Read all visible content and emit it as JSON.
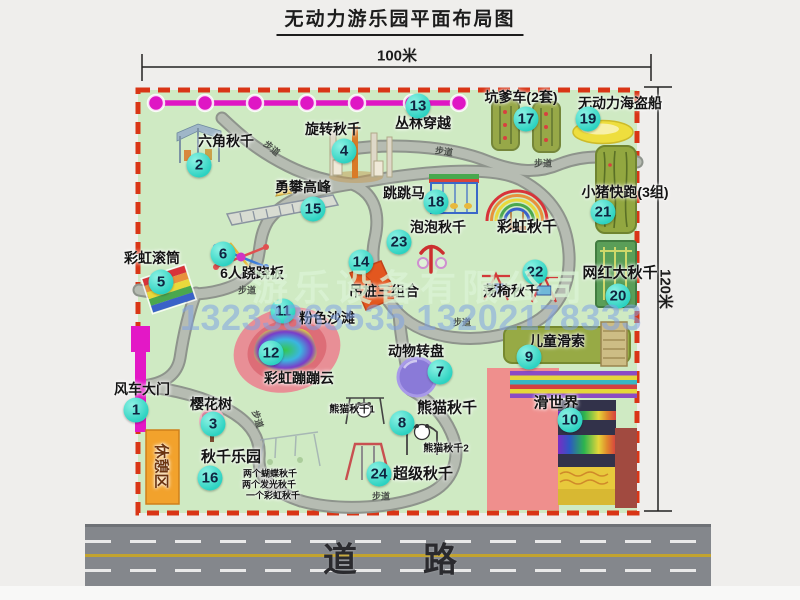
{
  "page": {
    "title": "无动力游乐园平面布局图"
  },
  "dimensions": {
    "top": "100米",
    "right": "120米"
  },
  "road": {
    "label": "道　路"
  },
  "watermark": {
    "company": "游乐设备有限公司",
    "phone": "13233863535 13202178333"
  },
  "colors": {
    "map_green": "#cfeac3",
    "border_red": "#d93516",
    "path_gray": "#b6bcb2",
    "badge_cyan": "#2cd2c1",
    "zipline_magenta": "#df16c4",
    "gate_magenta": "#e318c6",
    "rest_area_orange": "#f2a22c",
    "road_gray": "#84878c"
  },
  "map": {
    "pois": [
      {
        "num": 1,
        "label": "风车大门",
        "bx": 136,
        "by": 410,
        "lx": 142,
        "ly": 389,
        "fs": 14
      },
      {
        "num": 2,
        "label": "六角秋千",
        "bx": 199,
        "by": 165,
        "lx": 226,
        "ly": 141,
        "fs": 14
      },
      {
        "num": 3,
        "label": "樱花树",
        "bx": 213,
        "by": 424,
        "lx": 211,
        "ly": 404,
        "fs": 14
      },
      {
        "num": 4,
        "label": "旋转秋千",
        "bx": 344,
        "by": 151,
        "lx": 333,
        "ly": 129,
        "fs": 14
      },
      {
        "num": 5,
        "label": "彩虹滚筒",
        "bx": 161,
        "by": 282,
        "lx": 152,
        "ly": 258,
        "fs": 14
      },
      {
        "num": 6,
        "label": "6人跷跷板",
        "bx": 223,
        "by": 254,
        "lx": 252,
        "ly": 273,
        "fs": 14
      },
      {
        "num": 7,
        "label": "动物转盘",
        "bx": 440,
        "by": 372,
        "lx": 416,
        "ly": 351,
        "fs": 14
      },
      {
        "num": 8,
        "label": "熊猫秋千",
        "bx": 402,
        "by": 423,
        "lx": 447,
        "ly": 407,
        "fs": 15
      },
      {
        "num": 9,
        "label": "儿童滑索",
        "bx": 529,
        "by": 357,
        "lx": 557,
        "ly": 341,
        "fs": 14
      },
      {
        "num": 10,
        "label": "滑世界",
        "bx": 570,
        "by": 420,
        "lx": 556,
        "ly": 402,
        "fs": 15
      },
      {
        "num": 11,
        "label": "粉色沙滩",
        "bx": 283,
        "by": 311,
        "lx": 327,
        "ly": 318,
        "fs": 14
      },
      {
        "num": 12,
        "label": "彩虹蹦蹦云",
        "bx": 271,
        "by": 353,
        "lx": 299,
        "ly": 378,
        "fs": 14
      },
      {
        "num": 13,
        "label": "丛林穿越",
        "bx": 418,
        "by": 106,
        "lx": 423,
        "ly": 123,
        "fs": 14
      },
      {
        "num": 14,
        "label": "吊桩三组合",
        "bx": 361,
        "by": 262,
        "lx": 384,
        "ly": 291,
        "fs": 14
      },
      {
        "num": 15,
        "label": "勇攀高峰",
        "bx": 313,
        "by": 209,
        "lx": 303,
        "ly": 187,
        "fs": 14
      },
      {
        "num": 16,
        "label": "秋千乐园",
        "bx": 210,
        "by": 478,
        "lx": 231,
        "ly": 456,
        "fs": 15
      },
      {
        "num": 17,
        "label": "坑爹车(2套)",
        "bx": 526,
        "by": 119,
        "lx": 521,
        "ly": 97,
        "fs": 14
      },
      {
        "num": 18,
        "label": "跳跳马",
        "bx": 436,
        "by": 202,
        "lx": 404,
        "ly": 193,
        "fs": 14
      },
      {
        "num": 19,
        "label": "无动力海盗船",
        "bx": 588,
        "by": 119,
        "lx": 620,
        "ly": 103,
        "fs": 14
      },
      {
        "num": 20,
        "label": "网红大秋千",
        "bx": 618,
        "by": 296,
        "lx": 620,
        "ly": 272,
        "fs": 15
      },
      {
        "num": 21,
        "label": "小猪快跑(3组)",
        "bx": 603,
        "by": 212,
        "lx": 625,
        "ly": 192,
        "fs": 14
      },
      {
        "num": 22,
        "label": "荡椅秋千",
        "bx": 535,
        "by": 272,
        "lx": 511,
        "ly": 291,
        "fs": 14
      },
      {
        "num": 23,
        "label": "泡泡秋千",
        "bx": 399,
        "by": 242,
        "lx": 438,
        "ly": 227,
        "fs": 14
      },
      {
        "num": 24,
        "label": "超级秋千",
        "bx": 379,
        "by": 474,
        "lx": 423,
        "ly": 473,
        "fs": 15
      }
    ],
    "annotations": [
      {
        "label": "彩虹秋千",
        "x": 527,
        "y": 226,
        "fs": 15,
        "rot": 0
      },
      {
        "label": "熊猫秋千1",
        "x": 352,
        "y": 408,
        "fs": 10,
        "rot": 0
      },
      {
        "label": "熊猫秋千2",
        "x": 446,
        "y": 447,
        "fs": 10,
        "rot": 0
      },
      {
        "label": "两个蝴蝶秋千",
        "x": 270,
        "y": 473,
        "fs": 9,
        "rot": 0
      },
      {
        "label": "两个发光秋千",
        "x": 269,
        "y": 484,
        "fs": 9,
        "rot": 0
      },
      {
        "label": "一个彩虹秋千",
        "x": 273,
        "y": 495,
        "fs": 9,
        "rot": 0
      },
      {
        "label": "休憩区",
        "x": 162,
        "y": 466,
        "fs": 15,
        "rot": 90,
        "color": "#6b3410"
      }
    ],
    "path_label_text": "步道",
    "path_labels": [
      {
        "x": 272,
        "y": 148,
        "rot": 40
      },
      {
        "x": 444,
        "y": 151,
        "rot": 8
      },
      {
        "x": 543,
        "y": 163,
        "rot": 0
      },
      {
        "x": 247,
        "y": 290,
        "rot": 0
      },
      {
        "x": 462,
        "y": 322,
        "rot": 0
      },
      {
        "x": 258,
        "y": 419,
        "rot": 72
      },
      {
        "x": 381,
        "y": 496,
        "rot": 0
      }
    ]
  }
}
